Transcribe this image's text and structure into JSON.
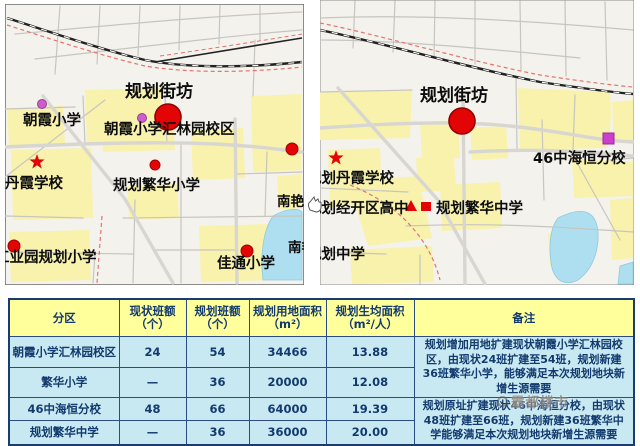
{
  "maps": {
    "left": {
      "block_label": "规划街坊",
      "labels": [
        "朝霞小学",
        "朝霞小学汇林园校区",
        "丹霞学校",
        "规划繁华小学",
        "工业园规划小学",
        "佳通小学",
        "南艳",
        "南艳"
      ],
      "markers": [
        "red-circle-large",
        "purple-circle",
        "purple-circle",
        "red-star",
        "red-dot",
        "red-dot",
        "red-dot",
        "red-dot"
      ]
    },
    "right": {
      "block_label": "规划街坊",
      "labels": [
        "46中海恒分校",
        "规划丹霞学校",
        "规划经开区高中",
        "规划繁华中学",
        "规划中学"
      ],
      "markers": [
        "red-circle-large",
        "magenta-square",
        "red-star",
        "red-triangle",
        "red-square"
      ]
    }
  },
  "table": {
    "headers": [
      {
        "line1": "分区",
        "line2": ""
      },
      {
        "line1": "现状班额",
        "line2": "（个）"
      },
      {
        "line1": "规划班额",
        "line2": "（个）"
      },
      {
        "line1": "规划用地面积",
        "line2": "（m²）"
      },
      {
        "line1": "规划生均面积",
        "line2": "（m²/人）"
      },
      {
        "line1": "备注",
        "line2": ""
      }
    ],
    "rows": [
      {
        "name": "朝霞小学汇林园校区",
        "current": "24",
        "planned": "54",
        "area": "34466",
        "per_capita": "13.88"
      },
      {
        "name": "繁华小学",
        "current": "—",
        "planned": "36",
        "area": "20000",
        "per_capita": "12.08"
      },
      {
        "name": "46中海恒分校",
        "current": "48",
        "planned": "66",
        "area": "64000",
        "per_capita": "19.39"
      },
      {
        "name": "规划繁华中学",
        "current": "—",
        "planned": "36",
        "area": "36000",
        "per_capita": "20.00"
      }
    ],
    "remarks": [
      "规划增加用地扩建现状朝霞小学汇林园校区，由现状24班扩建至54班，规划新建36班繁华小学，能够满足本次规划地块新增生源需要",
      "规划原址扩建现状46中海恒分校，由现状48班扩建至66班，规划新建36班繁华中学能够满足本次规划地块新增生源需要"
    ]
  },
  "watermark": {
    "text": "霸都楼市"
  },
  "colors": {
    "marker_red": "#e30505",
    "marker_purple": "#cc5ecc",
    "magenta_square": "#cc3fcc",
    "parcel_yellow": "#f8f2ad",
    "lake_blue": "#aedff0",
    "header_yellow": "#ffff9c",
    "row_blue": "#c9e9f2",
    "table_border": "#1b3c6e",
    "railway_black": "#222222",
    "boundary_red": "#e4736f"
  }
}
